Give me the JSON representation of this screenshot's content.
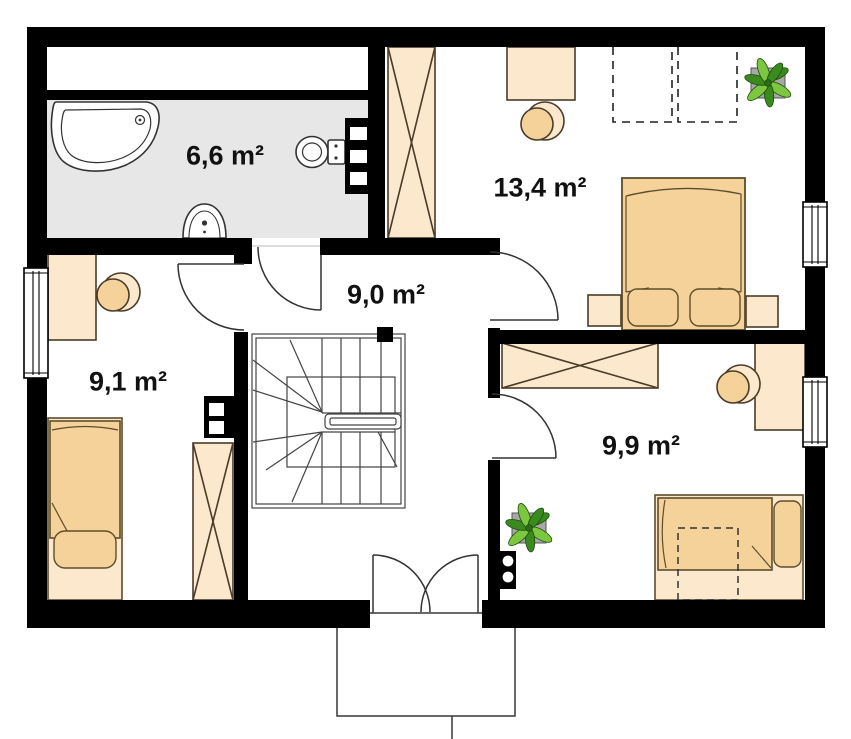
{
  "plan": {
    "kind": "floor-plan",
    "colors": {
      "wall": "#000000",
      "bath_floor": "#e7e7e7",
      "furniture_light": "#fbe8cd",
      "furniture_tan": "#f6d29b",
      "outline_brown": "#4a3c28",
      "plant_green_dark": "#3a8a1e",
      "plant_green_light": "#7dc63f",
      "label_color": "#111111"
    },
    "rooms": [
      {
        "id": "bathroom",
        "area_label": "6,6 m²",
        "fixtures": [
          "bathtub",
          "washbasin",
          "toilet",
          "installation-wall"
        ]
      },
      {
        "id": "bedroom-top-right",
        "area_label": "13,4 m²",
        "furniture": [
          "wardrobe",
          "desk",
          "stool",
          "double-bed",
          "nightstand-left",
          "nightstand-right",
          "plant",
          "dashed-skylight",
          "dashed-skylight"
        ]
      },
      {
        "id": "hall",
        "area_label": "9,0 m²",
        "features": [
          "u-shaped-staircase",
          "entry-double-door"
        ]
      },
      {
        "id": "bedroom-left",
        "area_label": "9,1 m²",
        "furniture": [
          "desk",
          "stool",
          "single-bed",
          "wardrobe",
          "chimney"
        ]
      },
      {
        "id": "bedroom-bottom-right",
        "area_label": "9,9 m²",
        "furniture": [
          "wardrobe",
          "desk",
          "stool",
          "single-bed",
          "under-bed-drawer",
          "plant",
          "chimney"
        ]
      }
    ],
    "exterior": {
      "features": [
        "balcony"
      ],
      "windows": 3
    }
  }
}
